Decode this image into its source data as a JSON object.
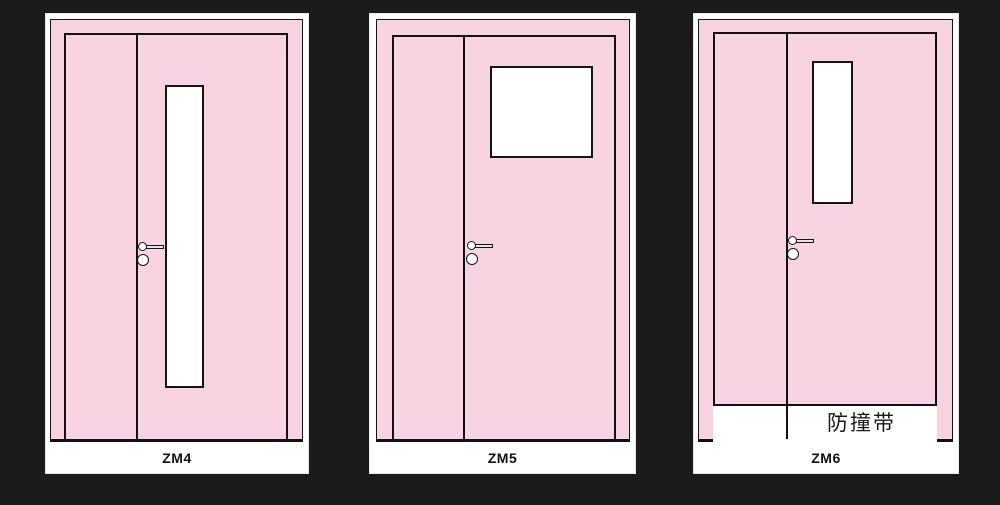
{
  "colors": {
    "background": "#1b1b1b",
    "door_pink": "#f8d3e2",
    "line_black": "#111111",
    "panel_white": "#ffffff"
  },
  "doors": [
    {
      "label": "ZM4",
      "vision_panel": "tall-narrow-vertical-window"
    },
    {
      "label": "ZM5",
      "vision_panel": "square-window"
    },
    {
      "label": "ZM6",
      "vision_panel": "short-narrow-vertical-window",
      "bump_strip_label": "防撞带"
    }
  ]
}
